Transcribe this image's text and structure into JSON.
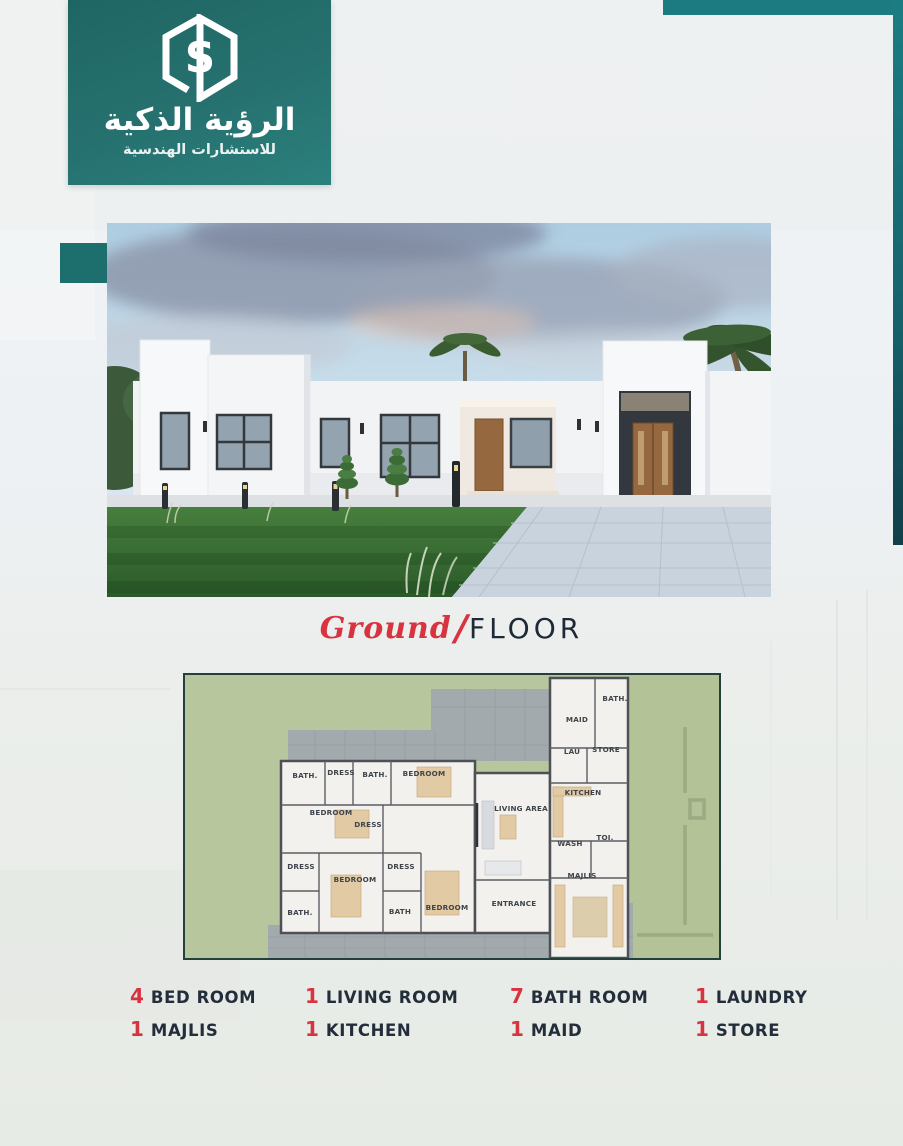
{
  "brand": {
    "logo_title_ar": "الرؤية الذكية",
    "logo_subtitle_ar": "للاستشارات الهندسية",
    "logo_monogram": "S"
  },
  "section_title": {
    "script_word": "Ground",
    "slash": "/",
    "main_word": "FLOOR"
  },
  "floor_plan": {
    "rooms": [
      {
        "label": "BATH.",
        "x": 120,
        "y": 103
      },
      {
        "label": "DRESS",
        "x": 156,
        "y": 100
      },
      {
        "label": "BATH.",
        "x": 190,
        "y": 102
      },
      {
        "label": "BEDROOM",
        "x": 239,
        "y": 101
      },
      {
        "label": "BEDROOM",
        "x": 146,
        "y": 140
      },
      {
        "label": "DRESS",
        "x": 183,
        "y": 152
      },
      {
        "label": "DRESS",
        "x": 116,
        "y": 194
      },
      {
        "label": "BATH.",
        "x": 115,
        "y": 240
      },
      {
        "label": "BEDROOM",
        "x": 170,
        "y": 207
      },
      {
        "label": "DRESS",
        "x": 216,
        "y": 194
      },
      {
        "label": "BATH",
        "x": 215,
        "y": 239
      },
      {
        "label": "BEDROOM",
        "x": 262,
        "y": 235
      },
      {
        "label": "LIVING AREA",
        "x": 336,
        "y": 136
      },
      {
        "label": "ENTRANCE",
        "x": 329,
        "y": 231
      },
      {
        "label": "MAID",
        "x": 392,
        "y": 47
      },
      {
        "label": "BATH.",
        "x": 430,
        "y": 26
      },
      {
        "label": "LAU",
        "x": 387,
        "y": 79
      },
      {
        "label": "STORE",
        "x": 421,
        "y": 77
      },
      {
        "label": "KITCHEN",
        "x": 398,
        "y": 120
      },
      {
        "label": "WASH",
        "x": 385,
        "y": 171
      },
      {
        "label": "TOI.",
        "x": 420,
        "y": 165
      },
      {
        "label": "MAJLIS",
        "x": 397,
        "y": 203
      }
    ]
  },
  "features": [
    {
      "count": "4",
      "label": "BED ROOM"
    },
    {
      "count": "1",
      "label": "LIVING ROOM"
    },
    {
      "count": "7",
      "label": "BATH ROOM"
    },
    {
      "count": "1",
      "label": "LAUNDRY"
    },
    {
      "count": "1",
      "label": "MAJLIS"
    },
    {
      "count": "1",
      "label": "KITCHEN"
    },
    {
      "count": "1",
      "label": "MAID"
    },
    {
      "count": "1",
      "label": "STORE"
    }
  ],
  "colors": {
    "teal_brand": "#26716f",
    "teal_bar": "#1b7b80",
    "teal_strip_dark": "#113f4a",
    "accent_red": "#d7343f",
    "text_navy": "#232e3a",
    "plan_green": "#b8c69d",
    "plan_paving_gray": "#a3aaae",
    "lawn_green": "#3a7437",
    "driveway_gray": "#c9d3dd",
    "wood_door": "#96683f"
  }
}
